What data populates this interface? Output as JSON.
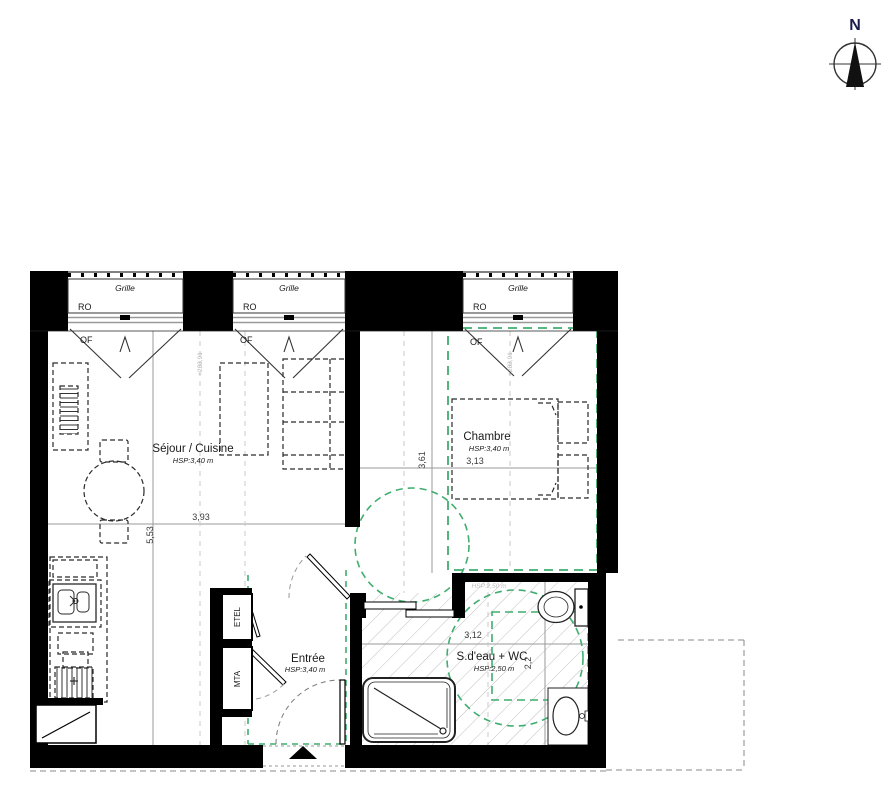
{
  "north": {
    "label": "N"
  },
  "windows": [
    {
      "grille": "Grille",
      "ro": "RO",
      "of": "OF"
    },
    {
      "grille": "Grille",
      "ro": "RO",
      "of": "OF"
    },
    {
      "grille": "Grille",
      "ro": "RO",
      "of": "OF"
    }
  ],
  "rooms": {
    "sejour": {
      "name": "Séjour / Cuisine",
      "height": "HSP:3,40 m"
    },
    "chambre": {
      "name": "Chambre",
      "height": "HSP:3,40 m"
    },
    "entree": {
      "name": "Entrée",
      "height": "HSP:3,40 m"
    },
    "bath": {
      "name": "S.d'eau + WC",
      "height": "HSP:2,50 m",
      "height_faint": "HSP:2,50 m"
    }
  },
  "dimensions": {
    "sejour_width": "3,93",
    "sejour_depth": "5,53",
    "chambre_depth": "3,61",
    "chambre_width": "3,13",
    "bath_width": "3,12",
    "bath_depth": "2,2"
  },
  "closets": {
    "etel": "ETEL",
    "mta": "MTA"
  },
  "levels": {
    "left": "+283,91",
    "right": "+283,91"
  },
  "colors": {
    "accessibility_green": "#3fae6e",
    "wall_black": "#000000",
    "dimension_gray": "#9a9a9a",
    "hatch_gray": "#b8b8b8"
  }
}
